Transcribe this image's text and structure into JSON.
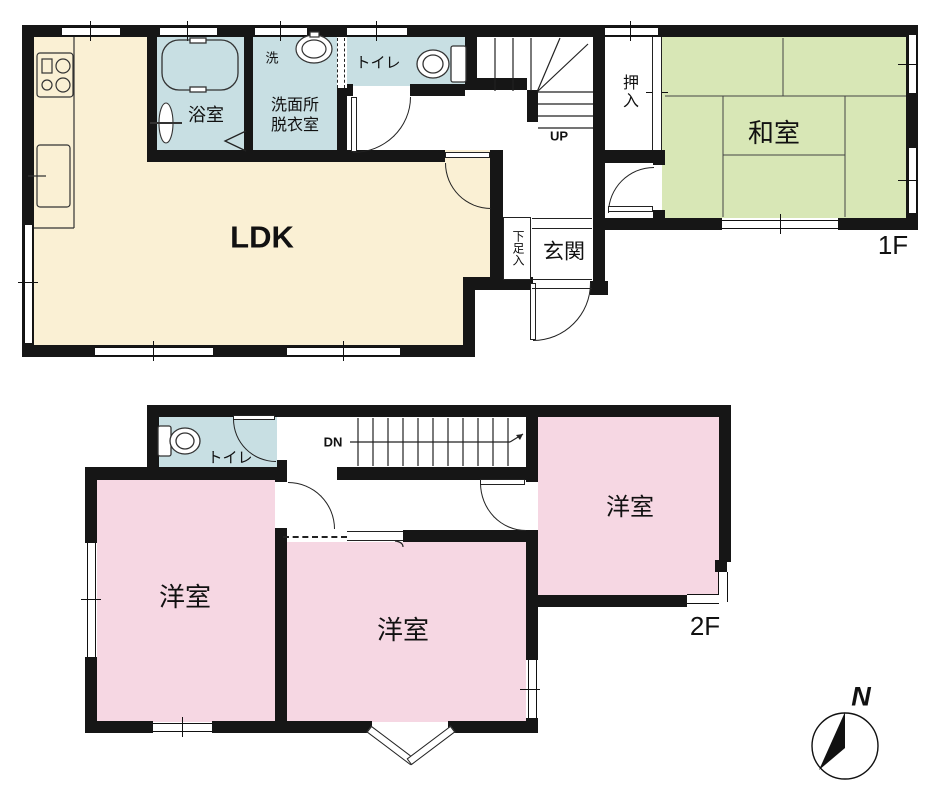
{
  "title": "2-story house floor plan",
  "colors": {
    "wall": "#161616",
    "ldk_fill": "#FAF0D4",
    "wet_area_fill": "#C8DFE3",
    "tatami_fill": "#D8E7B6",
    "western_room_fill": "#F6D7E3"
  },
  "floor1": {
    "floor_label": "1F",
    "rooms": {
      "ldk": "LDK",
      "bath": "浴室",
      "washroom_line1": "洗面所",
      "washroom_line2": "脱衣室",
      "laundry": "洗",
      "toilet": "トイレ",
      "stairs_up": "UP",
      "closet": "押入",
      "japanese_room": "和室",
      "shoe_cabinet": "下足入",
      "entrance": "玄関"
    }
  },
  "floor2": {
    "floor_label": "2F",
    "rooms": {
      "toilet": "トイレ",
      "stairs_down": "DN",
      "western_room_right": "洋室",
      "western_room_left": "洋室",
      "western_room_center": "洋室"
    }
  },
  "compass": {
    "north_label": "N"
  }
}
